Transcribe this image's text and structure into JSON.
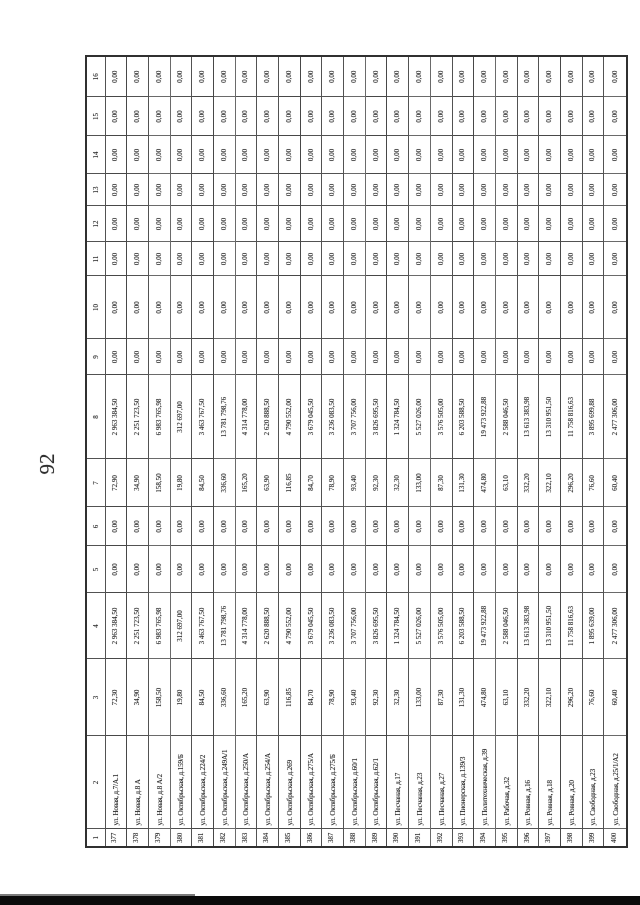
{
  "page": {
    "number": "92"
  },
  "table": {
    "column_headers": [
      "1",
      "2",
      "3",
      "4",
      "5",
      "6",
      "7",
      "8",
      "9",
      "10",
      "11",
      "12",
      "13",
      "14",
      "15",
      "16"
    ],
    "rows": [
      {
        "cells": [
          "377",
          "ул. Новая, д.7/А.1",
          "72,30",
          "2 963 384,50",
          "0,00",
          "0,00",
          "72,90",
          "2 963 384,50",
          "0,00",
          "0,00",
          "0,00",
          "0,00",
          "0,00",
          "0,00",
          "0,00",
          "0,00"
        ]
      },
      {
        "cells": [
          "378",
          "ул. Новая, д.8 А",
          "34,90",
          "2 251 723,50",
          "0,00",
          "0,00",
          "34,90",
          "2 251 723,50",
          "0,00",
          "0,00",
          "0,00",
          "0,00",
          "0,00",
          "0,00",
          "0,00",
          "0,00"
        ]
      },
      {
        "cells": [
          "379",
          "ул. Новая, д.8 А/2",
          "158,50",
          "6 983 765,98",
          "0,00",
          "0,00",
          "158,50",
          "6 983 765,98",
          "0,00",
          "0,00",
          "0,00",
          "0,00",
          "0,00",
          "0,00",
          "0,00",
          "0,00"
        ]
      },
      {
        "cells": [
          "380",
          "ул. Октябрьская, д.159/Б",
          "19,80",
          "312 697,00",
          "0,00",
          "0,00",
          "19,80",
          "312 697,00",
          "0,00",
          "0,00",
          "0,00",
          "0,00",
          "0,00",
          "0,00",
          "0,00",
          "0,00"
        ]
      },
      {
        "cells": [
          "381",
          "ул. Октябрьская, д.224/2",
          "84,50",
          "3 463 767,50",
          "0,00",
          "0,00",
          "84,50",
          "3 463 767,50",
          "0,00",
          "0,00",
          "0,00",
          "0,00",
          "0,00",
          "0,00",
          "0,00",
          "0,00"
        ]
      },
      {
        "cells": [
          "382",
          "ул. Октябрьская, д.249А/1",
          "336,60",
          "13 781 798,76",
          "0,00",
          "0,00",
          "336,60",
          "13 781 798,76",
          "0,00",
          "0,00",
          "0,00",
          "0,00",
          "0,00",
          "0,00",
          "0,00",
          "0,00"
        ]
      },
      {
        "cells": [
          "383",
          "ул. Октябрьская, д.250/А",
          "165,20",
          "4 314 778,00",
          "0,00",
          "0,00",
          "165,20",
          "4 314 778,00",
          "0,00",
          "0,00",
          "0,00",
          "0,00",
          "0,00",
          "0,00",
          "0,00",
          "0,00"
        ]
      },
      {
        "cells": [
          "384",
          "ул. Октябрьская, д.254/А",
          "63,90",
          "2 620 888,50",
          "0,00",
          "0,00",
          "63,90",
          "2 620 888,50",
          "0,00",
          "0,00",
          "0,00",
          "0,00",
          "0,00",
          "0,00",
          "0,00",
          "0,00"
        ]
      },
      {
        "cells": [
          "385",
          "ул. Октябрьская, д.269",
          "116,85",
          "4 790 552,00",
          "0,00",
          "0,00",
          "116,85",
          "4 790 552,00",
          "0,00",
          "0,00",
          "0,00",
          "0,00",
          "0,00",
          "0,00",
          "0,00",
          "0,00"
        ]
      },
      {
        "cells": [
          "386",
          "ул. Октябрьская, д.275/А",
          "84,70",
          "3 679 045,50",
          "0,00",
          "0,00",
          "84,70",
          "3 679 045,50",
          "0,00",
          "0,00",
          "0,00",
          "0,00",
          "0,00",
          "0,00",
          "0,00",
          "0,00"
        ]
      },
      {
        "cells": [
          "387",
          "ул. Октябрьская, д.275/Б",
          "78,90",
          "3 236 083,50",
          "0,00",
          "0,00",
          "78,90",
          "3 236 083,50",
          "0,00",
          "0,00",
          "0,00",
          "0,00",
          "0,00",
          "0,00",
          "0,00",
          "0,00"
        ]
      },
      {
        "cells": [
          "388",
          "ул. Октябрьская, д.60/1",
          "93,40",
          "3 707 756,00",
          "0,00",
          "0,00",
          "93,40",
          "3 707 756,00",
          "0,00",
          "0,00",
          "0,00",
          "0,00",
          "0,00",
          "0,00",
          "0,00",
          "0,00"
        ]
      },
      {
        "cells": [
          "389",
          "ул. Октябрьская, д.62/1",
          "92,30",
          "3 826 695,50",
          "0,00",
          "0,00",
          "92,30",
          "3 826 695,50",
          "0,00",
          "0,00",
          "0,00",
          "0,00",
          "0,00",
          "0,00",
          "0,00",
          "0,00"
        ]
      },
      {
        "cells": [
          "390",
          "ул. Песчаная, д.17",
          "32,30",
          "1 324 784,50",
          "0,00",
          "0,00",
          "32,30",
          "1 324 784,50",
          "0,00",
          "0,00",
          "0,00",
          "0,00",
          "0,00",
          "0,00",
          "0,00",
          "0,00"
        ]
      },
      {
        "cells": [
          "391",
          "ул. Песчаная, д.23",
          "133,00",
          "5 527 026,00",
          "0,00",
          "0,00",
          "133,00",
          "5 527 026,00",
          "0,00",
          "0,00",
          "0,00",
          "0,00",
          "0,00",
          "0,00",
          "0,00",
          "0,00"
        ]
      },
      {
        "cells": [
          "392",
          "ул. Песчаная, д.27",
          "87,30",
          "3 576 505,00",
          "0,00",
          "0,00",
          "87,30",
          "3 576 505,00",
          "0,00",
          "0,00",
          "0,00",
          "0,00",
          "0,00",
          "0,00",
          "0,00",
          "0,00"
        ]
      },
      {
        "cells": [
          "393",
          "ул. Пионерская, д.139/3",
          "131,30",
          "6 203 588,50",
          "0,00",
          "0,00",
          "131,30",
          "6 203 588,50",
          "0,00",
          "0,00",
          "0,00",
          "0,00",
          "0,00",
          "0,00",
          "0,00",
          "0,00"
        ]
      },
      {
        "cells": [
          "394",
          "ул. Политехническая, д.39",
          "474,80",
          "19 473 922,88",
          "0,00",
          "0,00",
          "474,80",
          "19 473 922,88",
          "0,00",
          "0,00",
          "0,00",
          "0,00",
          "0,00",
          "0,00",
          "0,00",
          "0,00"
        ]
      },
      {
        "cells": [
          "395",
          "ул. Рабочая, д.32",
          "63,10",
          "2 588 046,50",
          "0,00",
          "0,00",
          "63,10",
          "2 588 046,50",
          "0,00",
          "0,00",
          "0,00",
          "0,00",
          "0,00",
          "0,00",
          "0,00",
          "0,00"
        ]
      },
      {
        "cells": [
          "396",
          "ул. Ровная, д.16",
          "332,20",
          "13 613 383,98",
          "0,00",
          "0,00",
          "332,20",
          "13 613 383,98",
          "0,00",
          "0,00",
          "0,00",
          "0,00",
          "0,00",
          "0,00",
          "0,00",
          "0,00"
        ]
      },
      {
        "cells": [
          "397",
          "ул. Ровная, д.18",
          "322,10",
          "13 310 951,50",
          "0,00",
          "0,00",
          "322,10",
          "13 310 951,50",
          "0,00",
          "0,00",
          "0,00",
          "0,00",
          "0,00",
          "0,00",
          "0,00",
          "0,00"
        ]
      },
      {
        "cells": [
          "398",
          "ул. Ровная, д.20",
          "296,20",
          "11 758 816,63",
          "0,00",
          "0,00",
          "296,20",
          "11 758 816,63",
          "0,00",
          "0,00",
          "0,00",
          "0,00",
          "0,00",
          "0,00",
          "0,00",
          "0,00"
        ]
      },
      {
        "cells": [
          "399",
          "ул. Свободная, д.23",
          "76,60",
          "1 895 639,00",
          "0,00",
          "0,00",
          "76,60",
          "3 895 699,88",
          "0,00",
          "0,00",
          "0,00",
          "0,00",
          "0,00",
          "0,00",
          "0,00",
          "0,00"
        ]
      },
      {
        "cells": [
          "400",
          "ул. Свободная, д.25/1/А2",
          "60,40",
          "2 477 306,00",
          "0,00",
          "0,00",
          "60,40",
          "2 477 306,00",
          "0,00",
          "0,00",
          "0,00",
          "0,00",
          "0,00",
          "0,00",
          "0,00",
          "0,00"
        ]
      }
    ]
  }
}
